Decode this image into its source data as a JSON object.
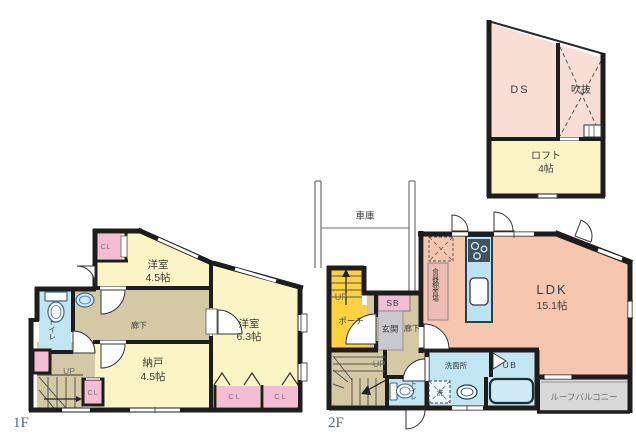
{
  "floor_1f": {
    "floor_label": "1F",
    "room_west_name": "洋室",
    "room_west_size": "4.5帖",
    "room_east_name": "洋室",
    "room_east_size": "6.3帖",
    "storage_name": "納戸",
    "storage_size": "4.5帖",
    "hallway": "廊下",
    "toilet": "トイレ",
    "stairs": "UP",
    "closet_top": "CL",
    "closet_small": "CL",
    "closet_right_1": "CL",
    "closet_right_2": "CL"
  },
  "floor_2f": {
    "floor_label": "2F",
    "garage": "車庫",
    "stairs_upper": "UP",
    "porch": "ポーチ",
    "shoe_box": "SB",
    "entrance": "玄関",
    "hallway": "廊下",
    "cupboard_space": "食器棚置場",
    "ldk_name": "LDK",
    "ldk_size": "15.1帖",
    "stairs_lower": "UP",
    "toilet": "トイレ",
    "washroom": "洗面所",
    "washer_symbol": "洗",
    "unit_bath": "UB",
    "roof_balcony": "ルーフバルコニー"
  },
  "loft": {
    "duct_space": "DS",
    "void": "吹抜",
    "loft_name": "ロフト",
    "loft_size": "4帖"
  },
  "colors": {
    "room_yellow": "#fbf5c6",
    "accent_yellow": "#fdd23e",
    "salmon_ldk": "#f6c6ae",
    "salmon_light": "#f8ded4",
    "pink_closet": "#f3bed3",
    "cupboard_pink": "#eebcb4",
    "tan_hallway": "#d5c9a5",
    "blue_wet": "#c2e5f2",
    "gray_entrance": "#c9c9cd",
    "gray_balcony": "#d8d8d8",
    "wall": "#1d1d1d"
  }
}
